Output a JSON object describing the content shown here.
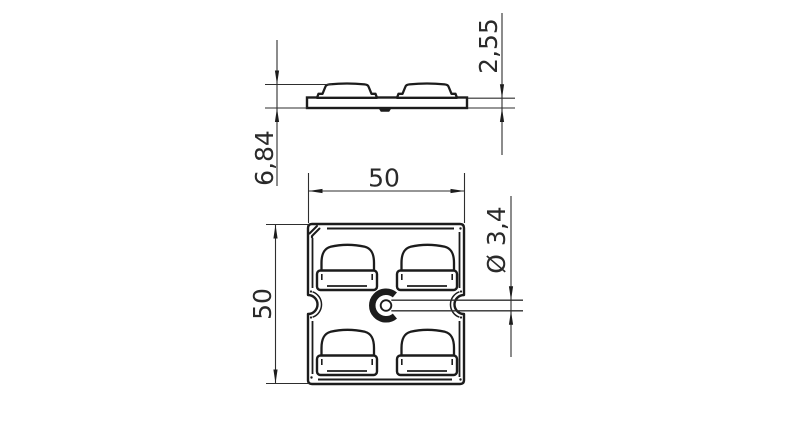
{
  "drawing": {
    "type": "technical-drawing",
    "background": "#ffffff",
    "outline_color": "#1c1c1c",
    "dimension_color": "#2a2a2a",
    "views": {
      "side_view": {
        "description": "side profile of plate with two dome pads",
        "dimensions": {
          "overall_height": {
            "label": "6,84"
          },
          "base_thickness": {
            "label": "2,55"
          }
        }
      },
      "plan_view": {
        "description": "square plate with four button pads, two edge notches and center hole with slot",
        "dimensions": {
          "width": {
            "label": "50"
          },
          "height": {
            "label": "50"
          },
          "hole_diameter": {
            "label": "Ø 3,4"
          }
        }
      }
    }
  }
}
